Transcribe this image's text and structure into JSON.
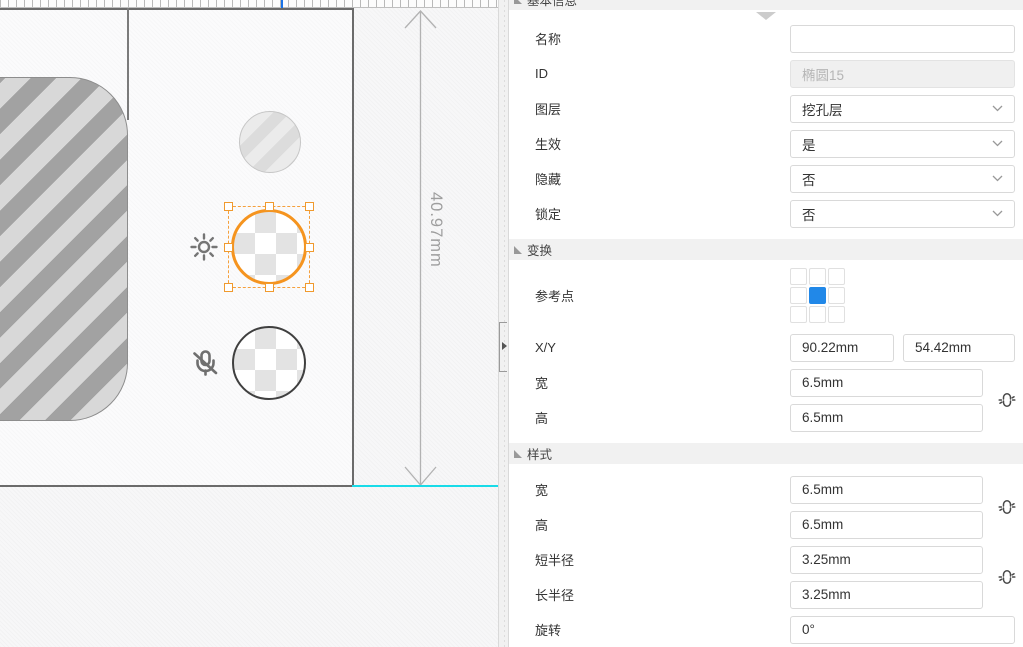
{
  "canvas": {
    "dimension_label": "40.97mm"
  },
  "panel": {
    "basic": {
      "title": "基本信息",
      "name_label": "名称",
      "name_value": "",
      "id_label": "ID",
      "id_value": "椭圆15",
      "layer_label": "图层",
      "layer_value": "挖孔层",
      "effective_label": "生效",
      "effective_value": "是",
      "hidden_label": "隐藏",
      "hidden_value": "否",
      "locked_label": "锁定",
      "locked_value": "否"
    },
    "transform": {
      "title": "变换",
      "refpoint_label": "参考点",
      "xy_label": "X/Y",
      "x_value": "90.22mm",
      "y_value": "54.42mm",
      "width_label": "宽",
      "width_value": "6.5mm",
      "height_label": "高",
      "height_value": "6.5mm"
    },
    "style": {
      "title": "样式",
      "width_label": "宽",
      "width_value": "6.5mm",
      "height_label": "高",
      "height_value": "6.5mm",
      "short_radius_label": "短半径",
      "short_radius_value": "3.25mm",
      "long_radius_label": "长半径",
      "long_radius_value": "3.25mm",
      "rotation_label": "旋转",
      "rotation_value": "0°"
    }
  },
  "icons": {
    "brightness": "sun-icon",
    "mic_muted": "mic-off-icon",
    "size_link": "broken-link-icon",
    "dropdown": "chevron-down-icon",
    "section_state": "triangle-expanded-icon",
    "panel_collapse": "arrow-down-icon",
    "splitter": "panel-collapse-handle-icon"
  },
  "colors": {
    "selection_orange": "#f5941f",
    "reference_point_blue": "#2188e8",
    "guide_cyan": "#19dbe8",
    "ruler_marker_blue": "#1a73e8"
  }
}
